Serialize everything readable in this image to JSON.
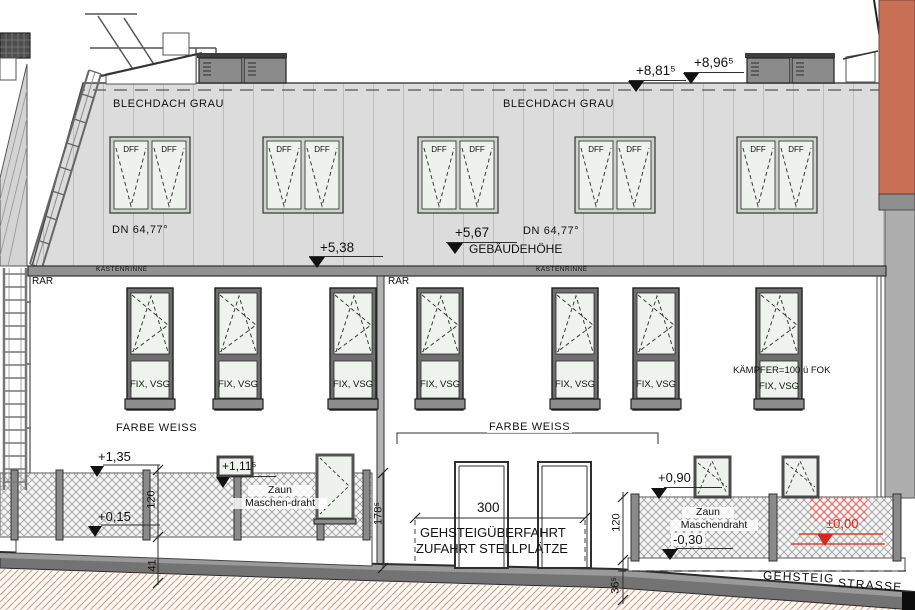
{
  "drawing": {
    "roof": {
      "material_left": "BLECHDACH GRAU",
      "material_right": "BLECHDACH GRAU",
      "slope_left": "DN 64,77°",
      "slope_right": "DN 64,77°",
      "window_label": "DFF",
      "gutter_left": "KASTENRINNE",
      "gutter_right": "KASTENRINNE"
    },
    "levels": {
      "top_roof": "+8,81⁵",
      "top_equipment": "+8,96⁵",
      "eave_left": "+5,38",
      "building_height_value": "+5,67",
      "building_height_label": "GEBÄUDEHÖHE",
      "fence_top_left": "+1,35",
      "fence_step_left": "+1,11⁵",
      "base_left": "+0,15",
      "fence_top_right": "+0,90",
      "base_right": "-0,30",
      "zero_level": "±0,00"
    },
    "facade": {
      "rar_left": "RAR",
      "rar_mid": "RAR",
      "glazing": "FIX, VSG",
      "kaempfer": "KÄMPFER=100 ü FOK",
      "color_left": "FARBE WEISS",
      "color_mid": "FARBE WEISS"
    },
    "dimensions": {
      "fence_height_left": "120",
      "plinth_left": "41",
      "wall_height": "178⁵",
      "gate_width": "300",
      "fence_height_right": "120",
      "curb_right": "36⁵"
    },
    "site": {
      "driveway_line1": "GEHSTEIGÜBERFAHRT",
      "driveway_line2": "ZUFAHRT STELLPLÄTZE",
      "sidewalk": "GEHSTEIG",
      "street": "STRASSE",
      "fence_word_left": "Zaun",
      "fence_type_left": "Maschen-draht",
      "fence_word_right": "Zaun",
      "fence_type_right": "Maschendraht"
    },
    "colors": {
      "accent_red": "#d8281e",
      "neighbor_orange": "#c96f55",
      "roof_gray": "#dcdcdc",
      "frame_gray": "#6e6e6e"
    }
  }
}
